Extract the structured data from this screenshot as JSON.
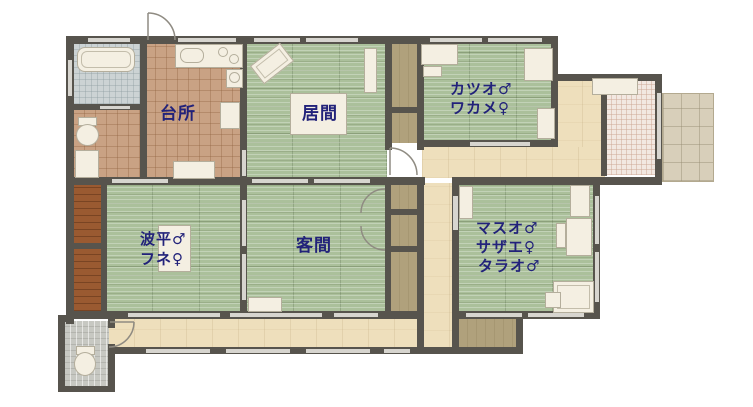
{
  "plan_title": "house-floor-plan",
  "rooms": {
    "kitchen": {
      "label": "台所"
    },
    "living": {
      "label": "居間"
    },
    "guest": {
      "label": "客間"
    },
    "katsuo_wakame": {
      "lines": [
        "カツオ♂",
        "ワカメ♀"
      ]
    },
    "namihei_fune": {
      "lines": [
        "波平♂",
        "フネ♀"
      ]
    },
    "masuo_sazae_tarao": {
      "lines": [
        "マスオ♂",
        "サザエ♀",
        "タラオ♂"
      ]
    }
  },
  "colors": {
    "wall": "#57544d",
    "tatami": "#abc09b",
    "wood_tile": "#c9a284",
    "hallway": "#eedfbc",
    "closet": "#b0a17c",
    "bath_tile": "#ccd3d4",
    "entry_tile": "#a8a59d",
    "toilet_tile": "#c7c8c2",
    "genkan_tile": "#f2e8e1",
    "terrace_stone": "#d8cfba",
    "wood_strip": "#9a5a31",
    "label_text": "#22227a",
    "furniture": "#f4efe2"
  }
}
